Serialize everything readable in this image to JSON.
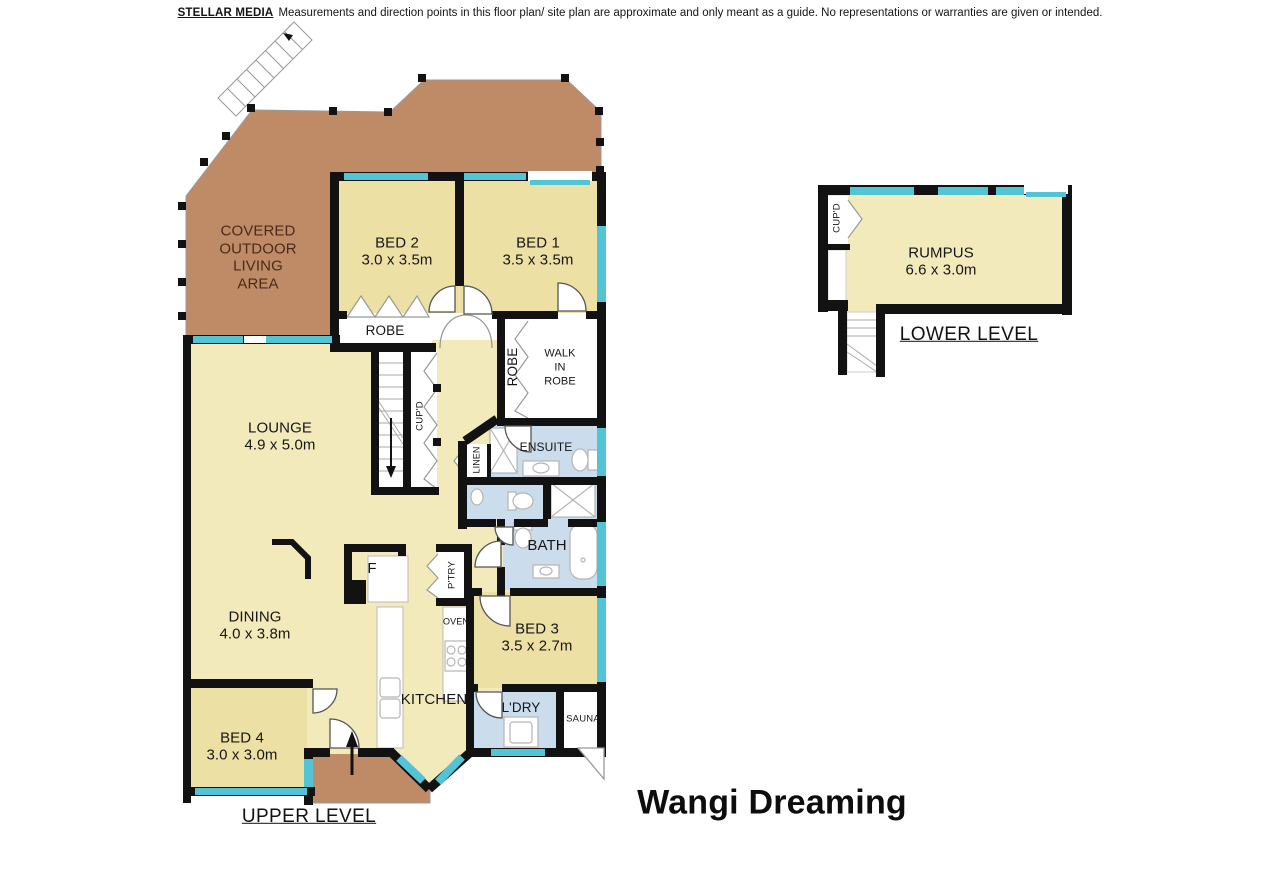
{
  "disclaimer": {
    "brand": "STELLAR MEDIA",
    "text": "Measurements and direction points in this floor plan/ site plan are approximate and only meant as a guide. No representations or warranties are given or intended."
  },
  "title": "Wangi Dreaming",
  "levels": {
    "upper": "UPPER LEVEL",
    "lower": "LOWER LEVEL"
  },
  "rooms": {
    "covered_outdoor": {
      "name": "COVERED\nOUTDOOR\nLIVING\nAREA"
    },
    "bed1": {
      "name": "BED 1",
      "dims": "3.5 x 3.5m"
    },
    "bed2": {
      "name": "BED 2",
      "dims": "3.0 x 3.5m"
    },
    "bed3": {
      "name": "BED 3",
      "dims": "3.5 x 2.7m"
    },
    "bed4": {
      "name": "BED 4",
      "dims": "3.0 x 3.0m"
    },
    "lounge": {
      "name": "LOUNGE",
      "dims": "4.9 x 5.0m"
    },
    "dining": {
      "name": "DINING",
      "dims": "4.0 x 3.8m"
    },
    "kitchen": {
      "name": "KITCHEN"
    },
    "rumpus": {
      "name": "RUMPUS",
      "dims": "6.6 x 3.0m"
    },
    "robe": {
      "name": "ROBE"
    },
    "robe_wir": {
      "name": "ROBE"
    },
    "walk_in_robe": {
      "name": "WALK\nIN\nROBE"
    },
    "ensuite": {
      "name": "ENSUITE"
    },
    "bath": {
      "name": "BATH"
    },
    "linen": {
      "name": "LINEN"
    },
    "cupd_upper": {
      "name": "CUP'D"
    },
    "cupd_lower": {
      "name": "CUP'D"
    },
    "pantry": {
      "name": "P'TRY"
    },
    "oven": {
      "name": "OVEN"
    },
    "fridge": {
      "name": "F"
    },
    "laundry": {
      "name": "L'DRY"
    },
    "sauna": {
      "name": "SAUNA"
    }
  },
  "colors": {
    "floor_living": "#F3EABB",
    "floor_bedroom": "#EDE0A5",
    "deck_brown": "#BF8B66",
    "wet_blue": "#CBDCEC",
    "window_teal": "#53C3D6",
    "wall": "#121212",
    "outdoor_text": "#4A2A1A"
  }
}
